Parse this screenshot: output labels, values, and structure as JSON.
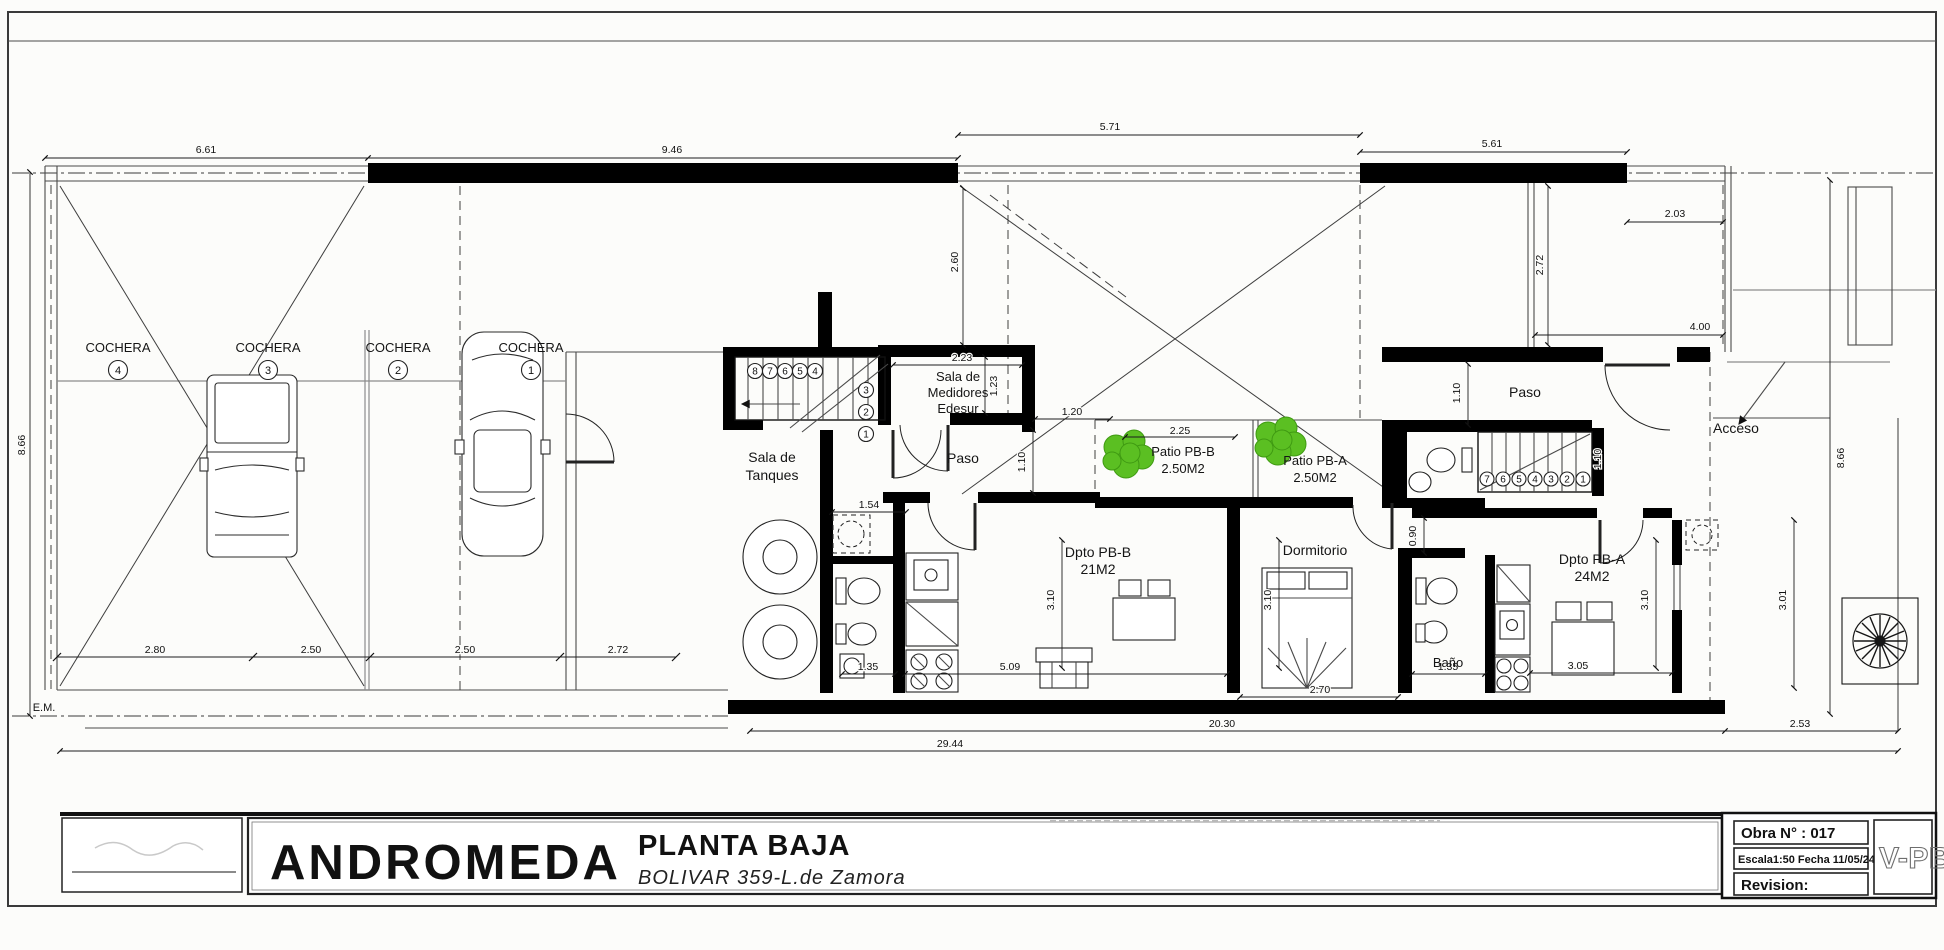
{
  "colors": {
    "wall": "#000000",
    "line": "#3c3c3c",
    "accent_green": "#5bbf22",
    "tree_ink": "#161616",
    "paper": "#fcfcfa"
  },
  "garage": {
    "unit_label": "COCHERA",
    "unit_numbers": [
      "4",
      "3",
      "2",
      "1"
    ]
  },
  "rooms": {
    "tanques_line1": "Sala de",
    "tanques_line2": "Tanques",
    "medidores_line1": "Sala de",
    "medidores_line2": "Medidores",
    "medidores_line3": "Edesur",
    "paso_left": "Paso",
    "paso_right": "Paso",
    "acceso": "Acceso",
    "patio_b_name": "Patio PB-B",
    "patio_b_area": "2.50M2",
    "patio_a_name": "Patio PB-A",
    "patio_a_area": "2.50M2",
    "dpto_b_name": "Dpto PB-B",
    "dpto_b_area": "21M2",
    "dormitorio": "Dormitorio",
    "bano": "Baño",
    "dpto_a_name": "Dpto PB-A",
    "dpto_a_area": "24M2"
  },
  "dims": {
    "top_661": "6.61",
    "top_946": "9.46",
    "top_571": "5.71",
    "top_561": "5.61",
    "top_203": "2.03",
    "top_272": "2.72",
    "top_400": "4.00",
    "void_260": "2.60",
    "left_866": "8.66",
    "right_866": "8.66",
    "gar_280": "2.80",
    "gar_250a": "2.50",
    "gar_250b": "2.50",
    "gar_272": "2.72",
    "med_223": "2.23",
    "med_123": "1.23",
    "cor_120": "1.20",
    "cor_110": "1.10",
    "paso_110": "1.10",
    "stair_110": "1.10",
    "patio_225": "2.25",
    "ante_154": "1.54",
    "bath_135": "1.35",
    "dpb_509": "5.09",
    "dorm_270": "2.70",
    "bano_135": "1.35",
    "dpa_305": "3.05",
    "dpb_310": "3.10",
    "dorm_310": "3.10",
    "dpa_310": "3.10",
    "right_301": "3.01",
    "door_090": "0.90",
    "bot_2030": "20.30",
    "bot_253": "2.53",
    "bot_2944": "29.44",
    "em": "E.M."
  },
  "stairs": {
    "left_numbers": [
      "8",
      "7",
      "6",
      "5",
      "4",
      "3",
      "2",
      "1"
    ],
    "right_numbers": [
      "7",
      "6",
      "5",
      "4",
      "3",
      "2",
      "1"
    ]
  },
  "title_block": {
    "project": "ANDROMEDA",
    "drawing_title": "PLANTA BAJA",
    "address": "BOLIVAR 359-L.de Zamora",
    "obra": "Obra N° : 017",
    "escala_fecha": "Escala1:50 Fecha 11/05/24",
    "revision_label": "Revision:",
    "sheet_code": "V-PB"
  }
}
